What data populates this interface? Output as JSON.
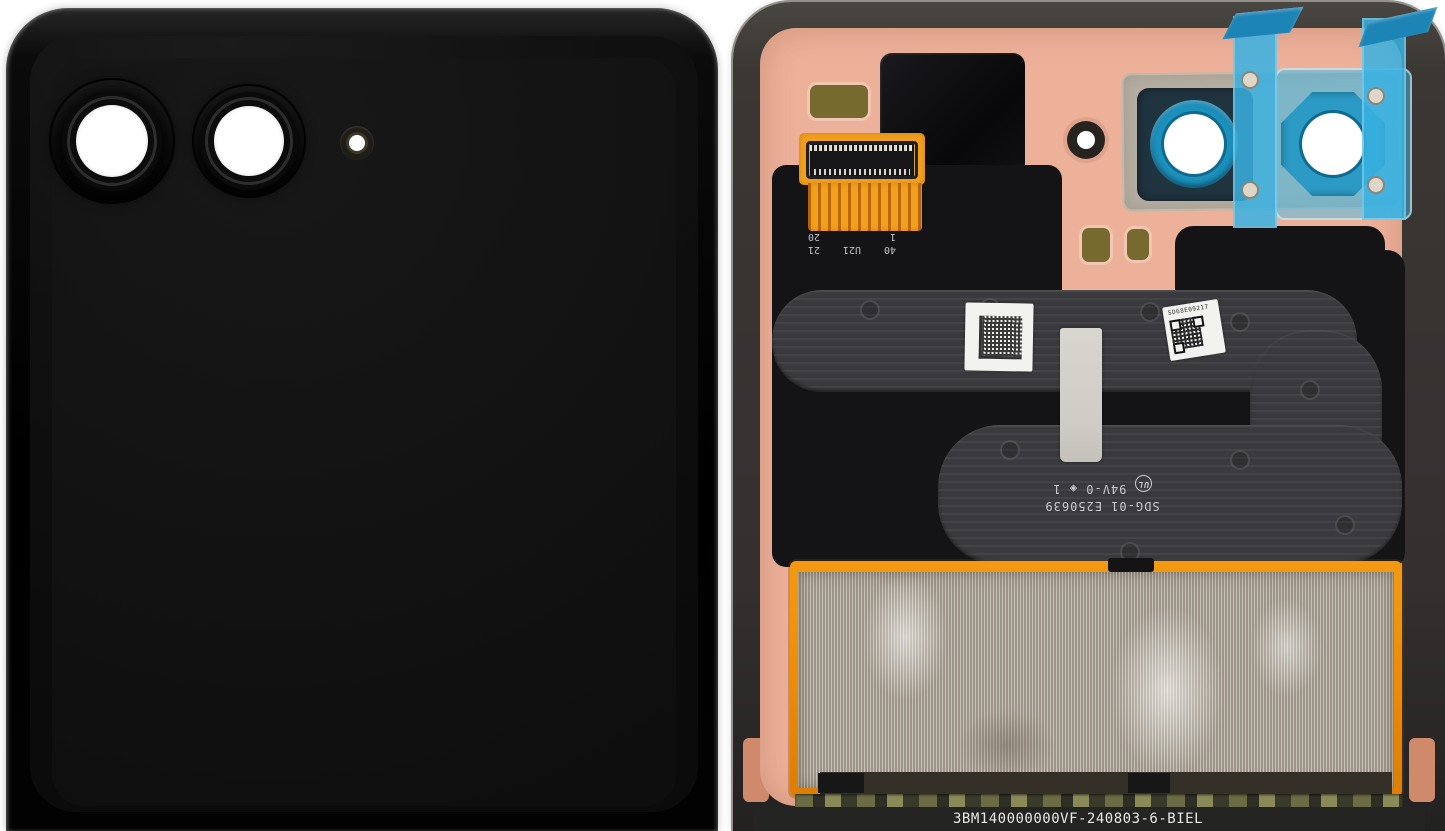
{
  "scene": {
    "description": "Foldable smartphone cover display assembly photographed from the front (glossy black cover with dual camera lenses and flash window) and from the inside (copper back plate with flex cables, camera deck, protective blue films and EMI foil)",
    "background": "#ffffff"
  },
  "front_panel": {
    "finish": "glossy black",
    "elements": [
      "camera-lens-1",
      "camera-lens-2",
      "flash-window"
    ]
  },
  "back_panel": {
    "connector_pins": {
      "a0": "40",
      "a1": "U21",
      "a2": "21",
      "b0": "1",
      "b1": "20"
    },
    "flex_marking": {
      "part_number": "SDG-01 E250639",
      "ul_mark": "UL",
      "rating": "94V-0",
      "mold_symbol": "◈",
      "cavity": "1"
    },
    "serial_label": "SD68E09217",
    "bottom_code": "3BM140000000VF-240803-6-BIEL"
  },
  "colors": {
    "copper_back": "#edb19a",
    "frame": "#3b3733",
    "flex_ribbon": "#3a3a3e",
    "adhesive_black": "#141417",
    "orange_flex": "#f2a01d",
    "copper_tape": "#ef8b06",
    "protective_film_blue": "#38b1e2",
    "camera_ring_blue": "#1b8fba",
    "emi_foil": "#b2aa9d",
    "label_white": "#f2f2ef"
  }
}
